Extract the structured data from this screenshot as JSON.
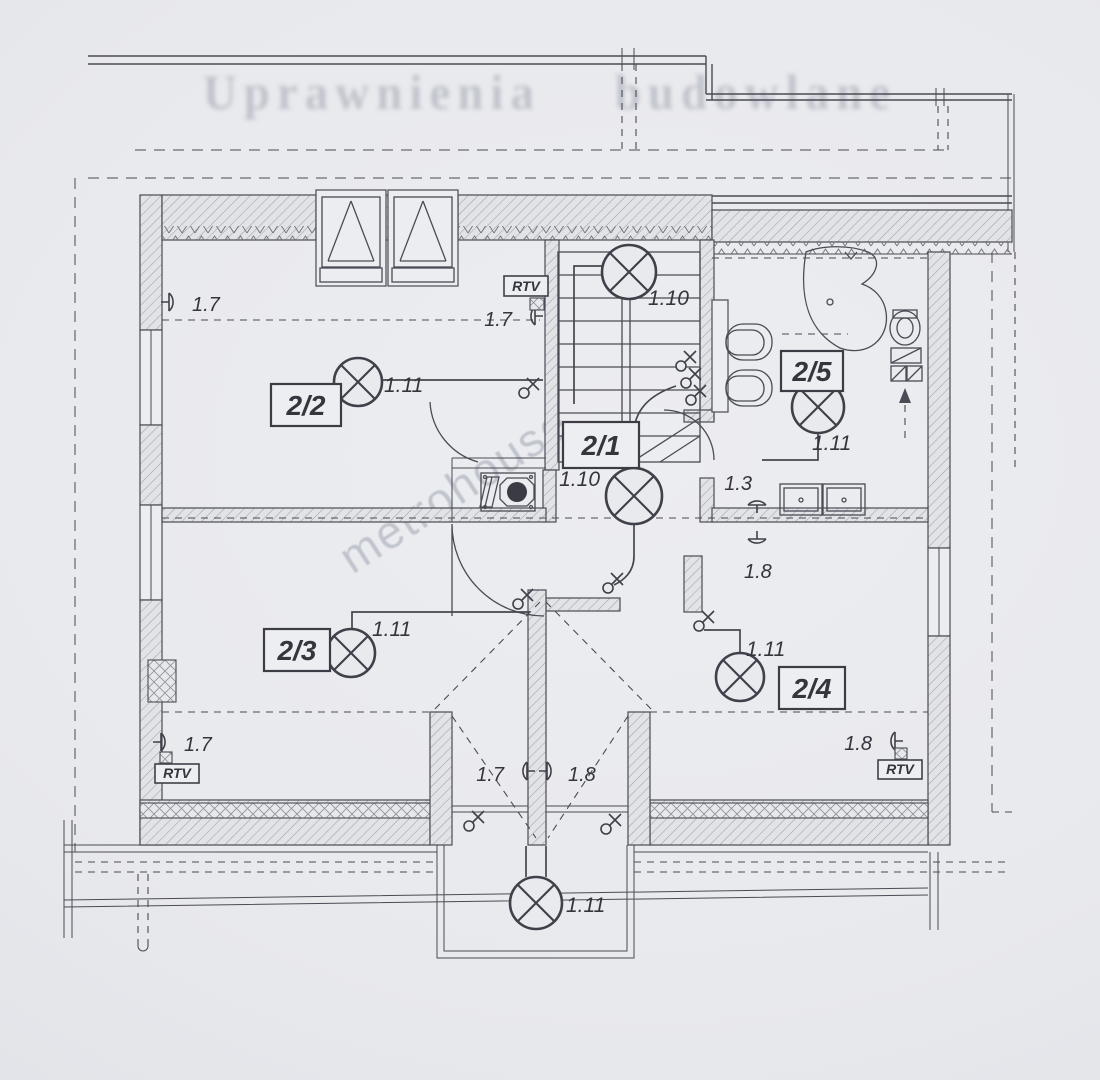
{
  "page": {
    "ghost_heading": "Uprawnienia budowlane",
    "watermark": "metrohouse",
    "paper_color": "#e8e9ed",
    "ink_color": "#4a4b54"
  },
  "plan": {
    "rooms": [
      {
        "id": "2-1",
        "label": "2/1"
      },
      {
        "id": "2-2",
        "label": "2/2"
      },
      {
        "id": "2-3",
        "label": "2/3"
      },
      {
        "id": "2-4",
        "label": "2/4"
      },
      {
        "id": "2-5",
        "label": "2/5"
      }
    ],
    "lamps": [
      {
        "location": "staircase",
        "label": "1.10"
      },
      {
        "location": "room-2-2",
        "label": "1.11"
      },
      {
        "location": "hall-2-1",
        "label": "1.10"
      },
      {
        "location": "room-2-5",
        "label": "1.11"
      },
      {
        "location": "room-2-3",
        "label": "1.11"
      },
      {
        "location": "room-2-4",
        "label": "1.11"
      },
      {
        "location": "balcony",
        "label": "1.11"
      }
    ],
    "sockets": [
      {
        "location": "left-wall-top",
        "label": "1.7"
      },
      {
        "location": "stair-wall",
        "label": "1.7"
      },
      {
        "location": "bath-wall-north",
        "label": "1.3"
      },
      {
        "location": "bath-wall-south",
        "label": "1.8"
      },
      {
        "location": "left-wall-bottom",
        "label": "1.7"
      },
      {
        "location": "balcony-door-left",
        "label": "1.7"
      },
      {
        "location": "balcony-door-right",
        "label": "1.8"
      },
      {
        "location": "right-wall-bottom",
        "label": "1.8"
      }
    ],
    "rtv_boxes": [
      {
        "location": "stair-wall-top",
        "label": "RTV"
      },
      {
        "location": "bottom-left",
        "label": "RTV"
      },
      {
        "location": "bottom-right",
        "label": "RTV"
      }
    ]
  }
}
